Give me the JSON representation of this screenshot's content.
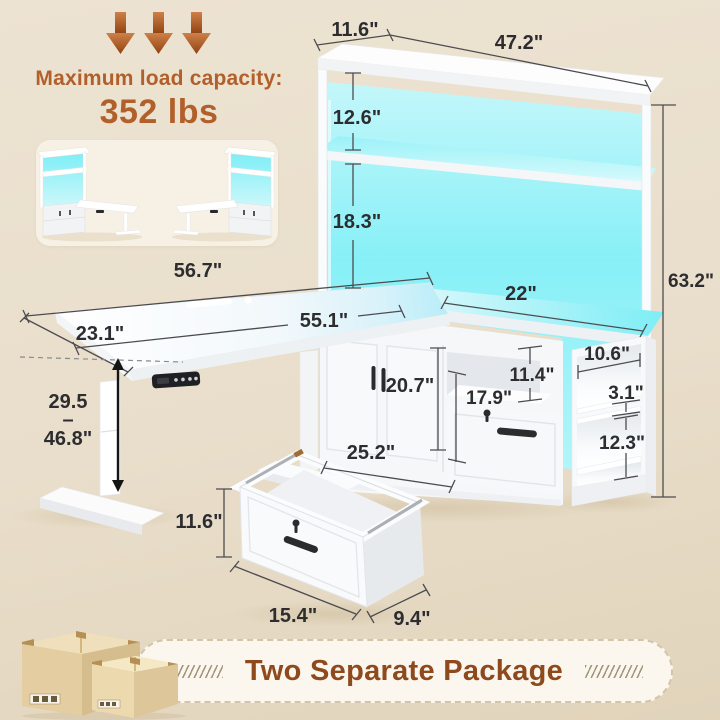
{
  "header": {
    "title": "Maximum load capacity:",
    "value": "352 lbs"
  },
  "dimensions": {
    "hutch_depth": "11.6\"",
    "hutch_width": "47.2\"",
    "top_shelf_gap": "12.6\"",
    "bottom_shelf_gap": "18.3\"",
    "total_height": "63.2\"",
    "desk_full_length": "56.7\"",
    "desktop_length": "55.1\"",
    "desktop_depth": "23.1\"",
    "return_width": "22\"",
    "door_section_height": "20.7\"",
    "cabinet_width": "25.2\"",
    "cubby_height": "11.4\"",
    "file_drawer_height": "17.9\"",
    "side_shelf_depth": "10.6\"",
    "side_shelf_gap": "3.1\"",
    "side_shelf_height": "12.3\"",
    "drawer_height": "11.6\"",
    "drawer_width": "15.4\"",
    "drawer_depth": "9.4\""
  },
  "height_range": {
    "min": "29.5",
    "separator": "–",
    "max": "46.8\""
  },
  "footer": {
    "package_note": "Two Separate Package"
  },
  "colors": {
    "accent_brown": "#b2602b",
    "banner_text": "#8e4a1d",
    "led_cyan": "#7deef6",
    "background": "#e9decb",
    "furniture_white": "#ffffff",
    "dimension_text": "#2d2d30"
  },
  "icons": {
    "load_arrows": "down-arrow-icon",
    "packages": "package-boxes-icon",
    "banner_hatch": "slash-hatch-icon"
  }
}
